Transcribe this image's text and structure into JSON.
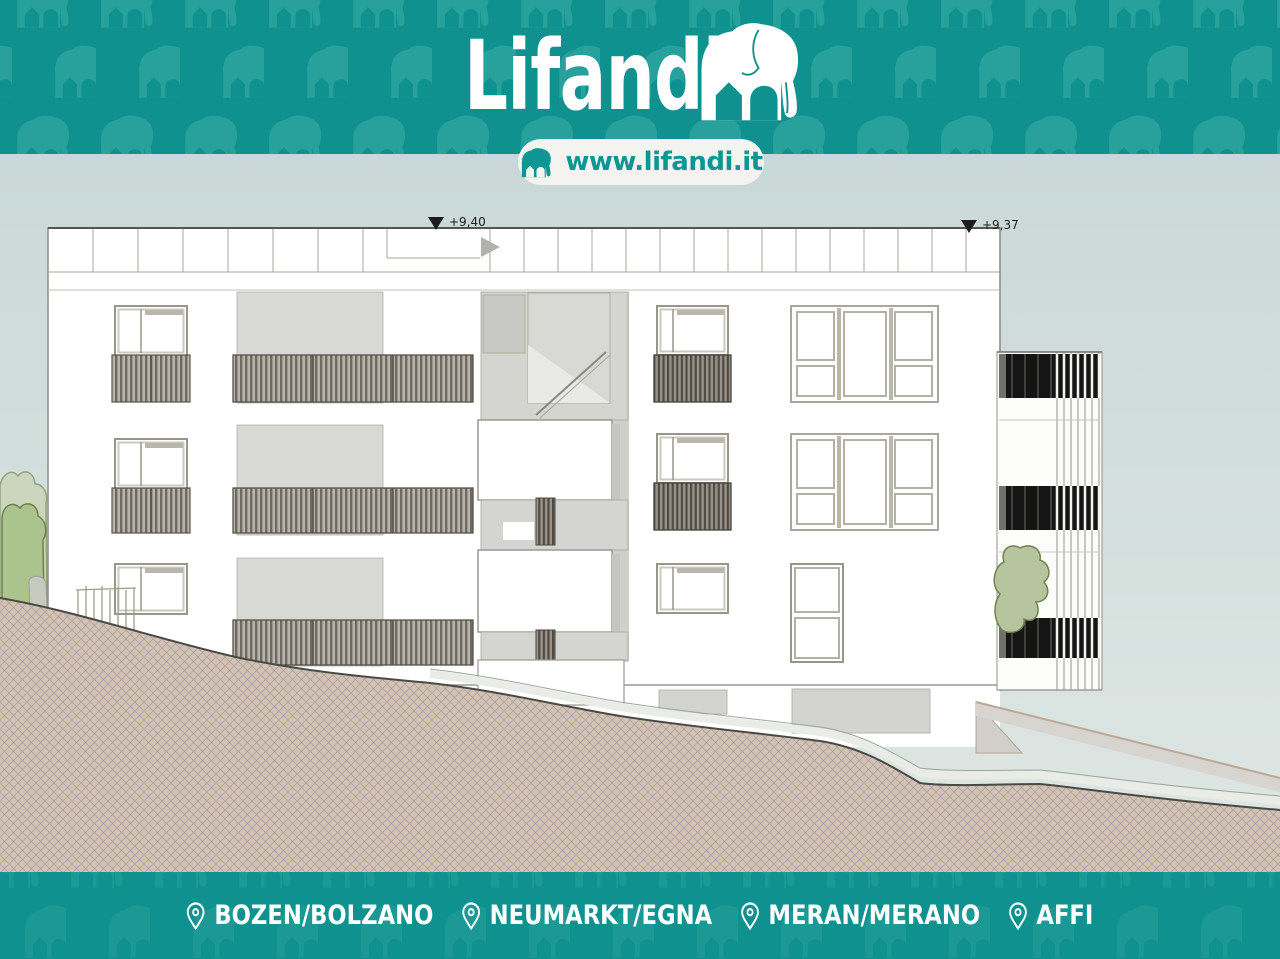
{
  "brand": {
    "logo_text": "Lifandi",
    "website": "www.lifandi.it"
  },
  "drawing": {
    "elevation_marks": [
      {
        "label": "+9,40"
      },
      {
        "label": "+9,37"
      }
    ]
  },
  "footer": {
    "locations": [
      {
        "label": "BOZEN/BOLZANO"
      },
      {
        "label": "NEUMARKT/EGNA"
      },
      {
        "label": "MERAN/MERANO"
      },
      {
        "label": "AFFI"
      }
    ]
  },
  "colors": {
    "teal": "#0F928F",
    "teal_pattern": "#2BA19D",
    "pill_bg": "#F3F4EF",
    "pill_text": "#0E9694",
    "backdrop_top": "#C9D8D8",
    "backdrop_bottom": "#DEE6E2",
    "facade": "#FFFFFF",
    "recess_grey": "#D8D8D4",
    "glazing_dark": "#151515",
    "terrain": "#D6C2B1",
    "greenery": "#ABC48E"
  }
}
